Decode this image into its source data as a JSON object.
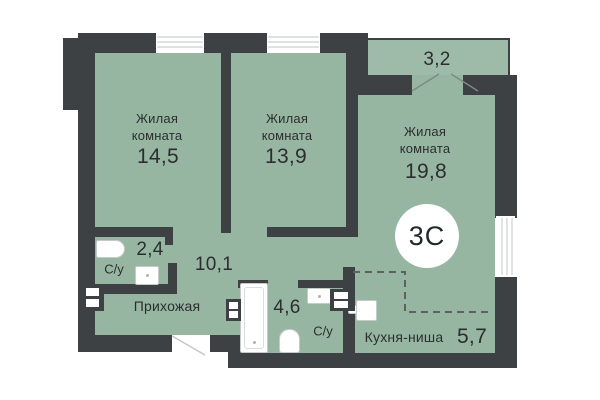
{
  "colors": {
    "wall": "#3d4144",
    "floor": "#97b6a2",
    "balcony_floor": "#9dbba8",
    "text": "#2b2e2f"
  },
  "badge": "3С",
  "rooms": {
    "living1": {
      "name": "Жилая комната",
      "area": "14,5"
    },
    "living2": {
      "name": "Жилая комната",
      "area": "13,9"
    },
    "living3": {
      "name": "Жилая комната",
      "area": "19,8"
    },
    "bath1": {
      "name": "С/у",
      "area": "2,4"
    },
    "bath2": {
      "name": "С/у",
      "area": "4,6"
    },
    "hallway": {
      "name": "Прихожая",
      "area": "10,1"
    },
    "kitchen": {
      "name": "Кухня-ниша",
      "area": "5,7"
    },
    "balcony": {
      "area": "3,2"
    }
  }
}
